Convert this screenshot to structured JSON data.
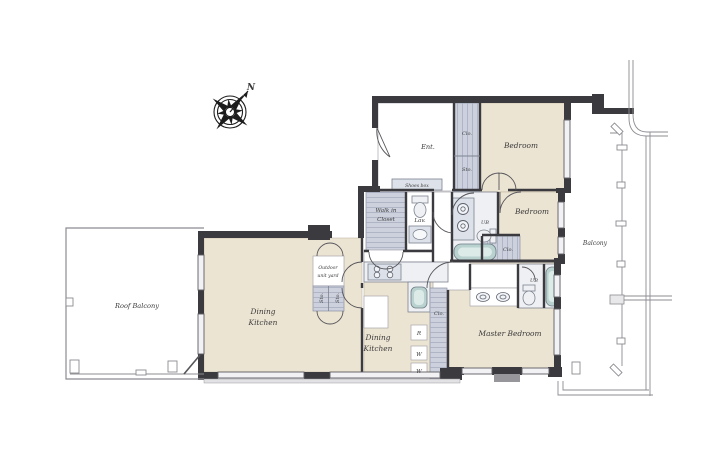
{
  "plan": {
    "compass": {
      "north": "N"
    },
    "rooms": {
      "entrance": "Ent.",
      "bedroom": "Bedroom",
      "master_bedroom": "Master Bedroom",
      "dining": "Dining",
      "kitchen": "Kitchen",
      "walk_in": "Walk in",
      "closet_word": "Closet",
      "roof_balcony": "Roof Balcony",
      "balcony": "Balcony"
    },
    "small": {
      "closet": "Clo.",
      "storage": "Sto.",
      "lavatory": "Lav.",
      "unit_bath": "UB",
      "shoes_box": "Shoes box",
      "outdoor_line1": "Outdoor",
      "outdoor_line2": "unit yard",
      "refrigerator": "R",
      "washer": "W"
    },
    "colors": {
      "wall": "#3b3b3f",
      "room_fill": "#ece4d3",
      "closet_fill": "#ccd1dd",
      "fixture_fill": "#eef0f4",
      "tub_fill": "#b9d2cf",
      "railing": "#8c8c92",
      "text": "#3a3a3a",
      "background": "#ffffff"
    }
  }
}
